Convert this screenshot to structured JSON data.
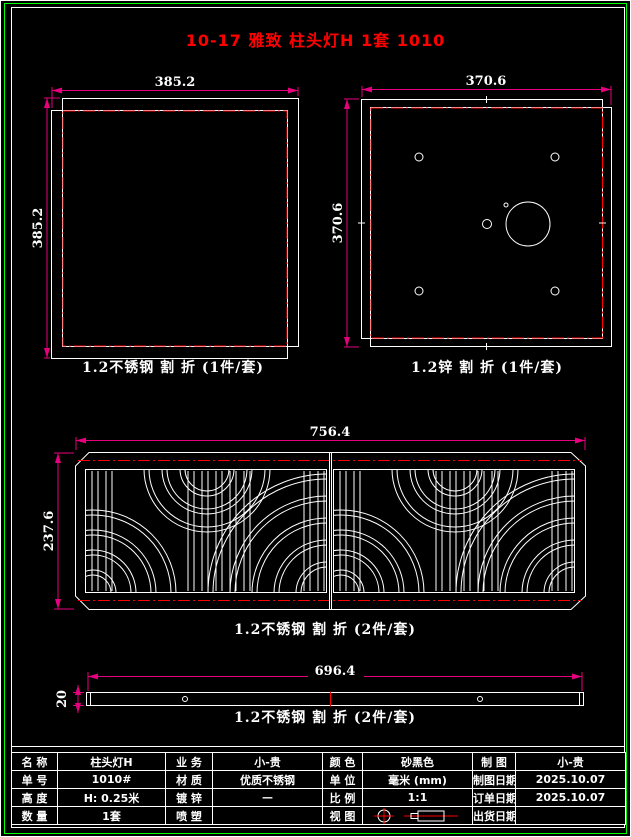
{
  "sheet": {
    "title": "10-17 雅致 柱头灯H 1套 1010"
  },
  "colors": {
    "background": "#000000",
    "line_white": "#ffffff",
    "fold_line_red": "#ff0000",
    "dimension_magenta": "#e6007e",
    "frame_green": "#00ff00",
    "title_red": "#ff0000"
  },
  "drawings": {
    "top_plate": {
      "width": "385.2",
      "height": "385.2",
      "caption": "1.2不锈钢 割 折 (1件/套)"
    },
    "base_plate": {
      "width": "370.6",
      "height": "370.6",
      "caption": "1.2锌 割 折 (1件/套)"
    },
    "lattice_panel": {
      "width": "756.4",
      "height": "237.6",
      "caption": "1.2不锈钢 割 折 (2件/套)"
    },
    "trim_strip": {
      "width": "696.4",
      "height": "20",
      "caption": "1.2不锈钢 割 折 (2件/套)"
    }
  },
  "title_block": {
    "view_symbol_icon": "first-angle-projection-icon",
    "rows": [
      {
        "cells": [
          {
            "label": "名 称",
            "value": "柱头灯H"
          },
          {
            "label": "业 务",
            "value": "小-贵"
          },
          {
            "label": "颜 色",
            "value": "砂黑色"
          },
          {
            "label": "制 图",
            "value": "小-贵"
          }
        ]
      },
      {
        "cells": [
          {
            "label": "单 号",
            "value": "1010#"
          },
          {
            "label": "材 质",
            "value": "优质不锈钢"
          },
          {
            "label": "单 位",
            "value": "毫米 (mm)"
          },
          {
            "label": "制图日期",
            "value": "2025.10.07"
          }
        ]
      },
      {
        "cells": [
          {
            "label": "高 度",
            "value": "H: 0.25米"
          },
          {
            "label": "镀 锌",
            "value": "—"
          },
          {
            "label": "比 例",
            "value": "1:1"
          },
          {
            "label": "订单日期",
            "value": "2025.10.07"
          }
        ]
      },
      {
        "cells": [
          {
            "label": "数 量",
            "value": "1套"
          },
          {
            "label": "喷 塑",
            "value": ""
          },
          {
            "label": "视 图",
            "value": ""
          },
          {
            "label": "出货日期",
            "value": ""
          }
        ]
      }
    ]
  }
}
